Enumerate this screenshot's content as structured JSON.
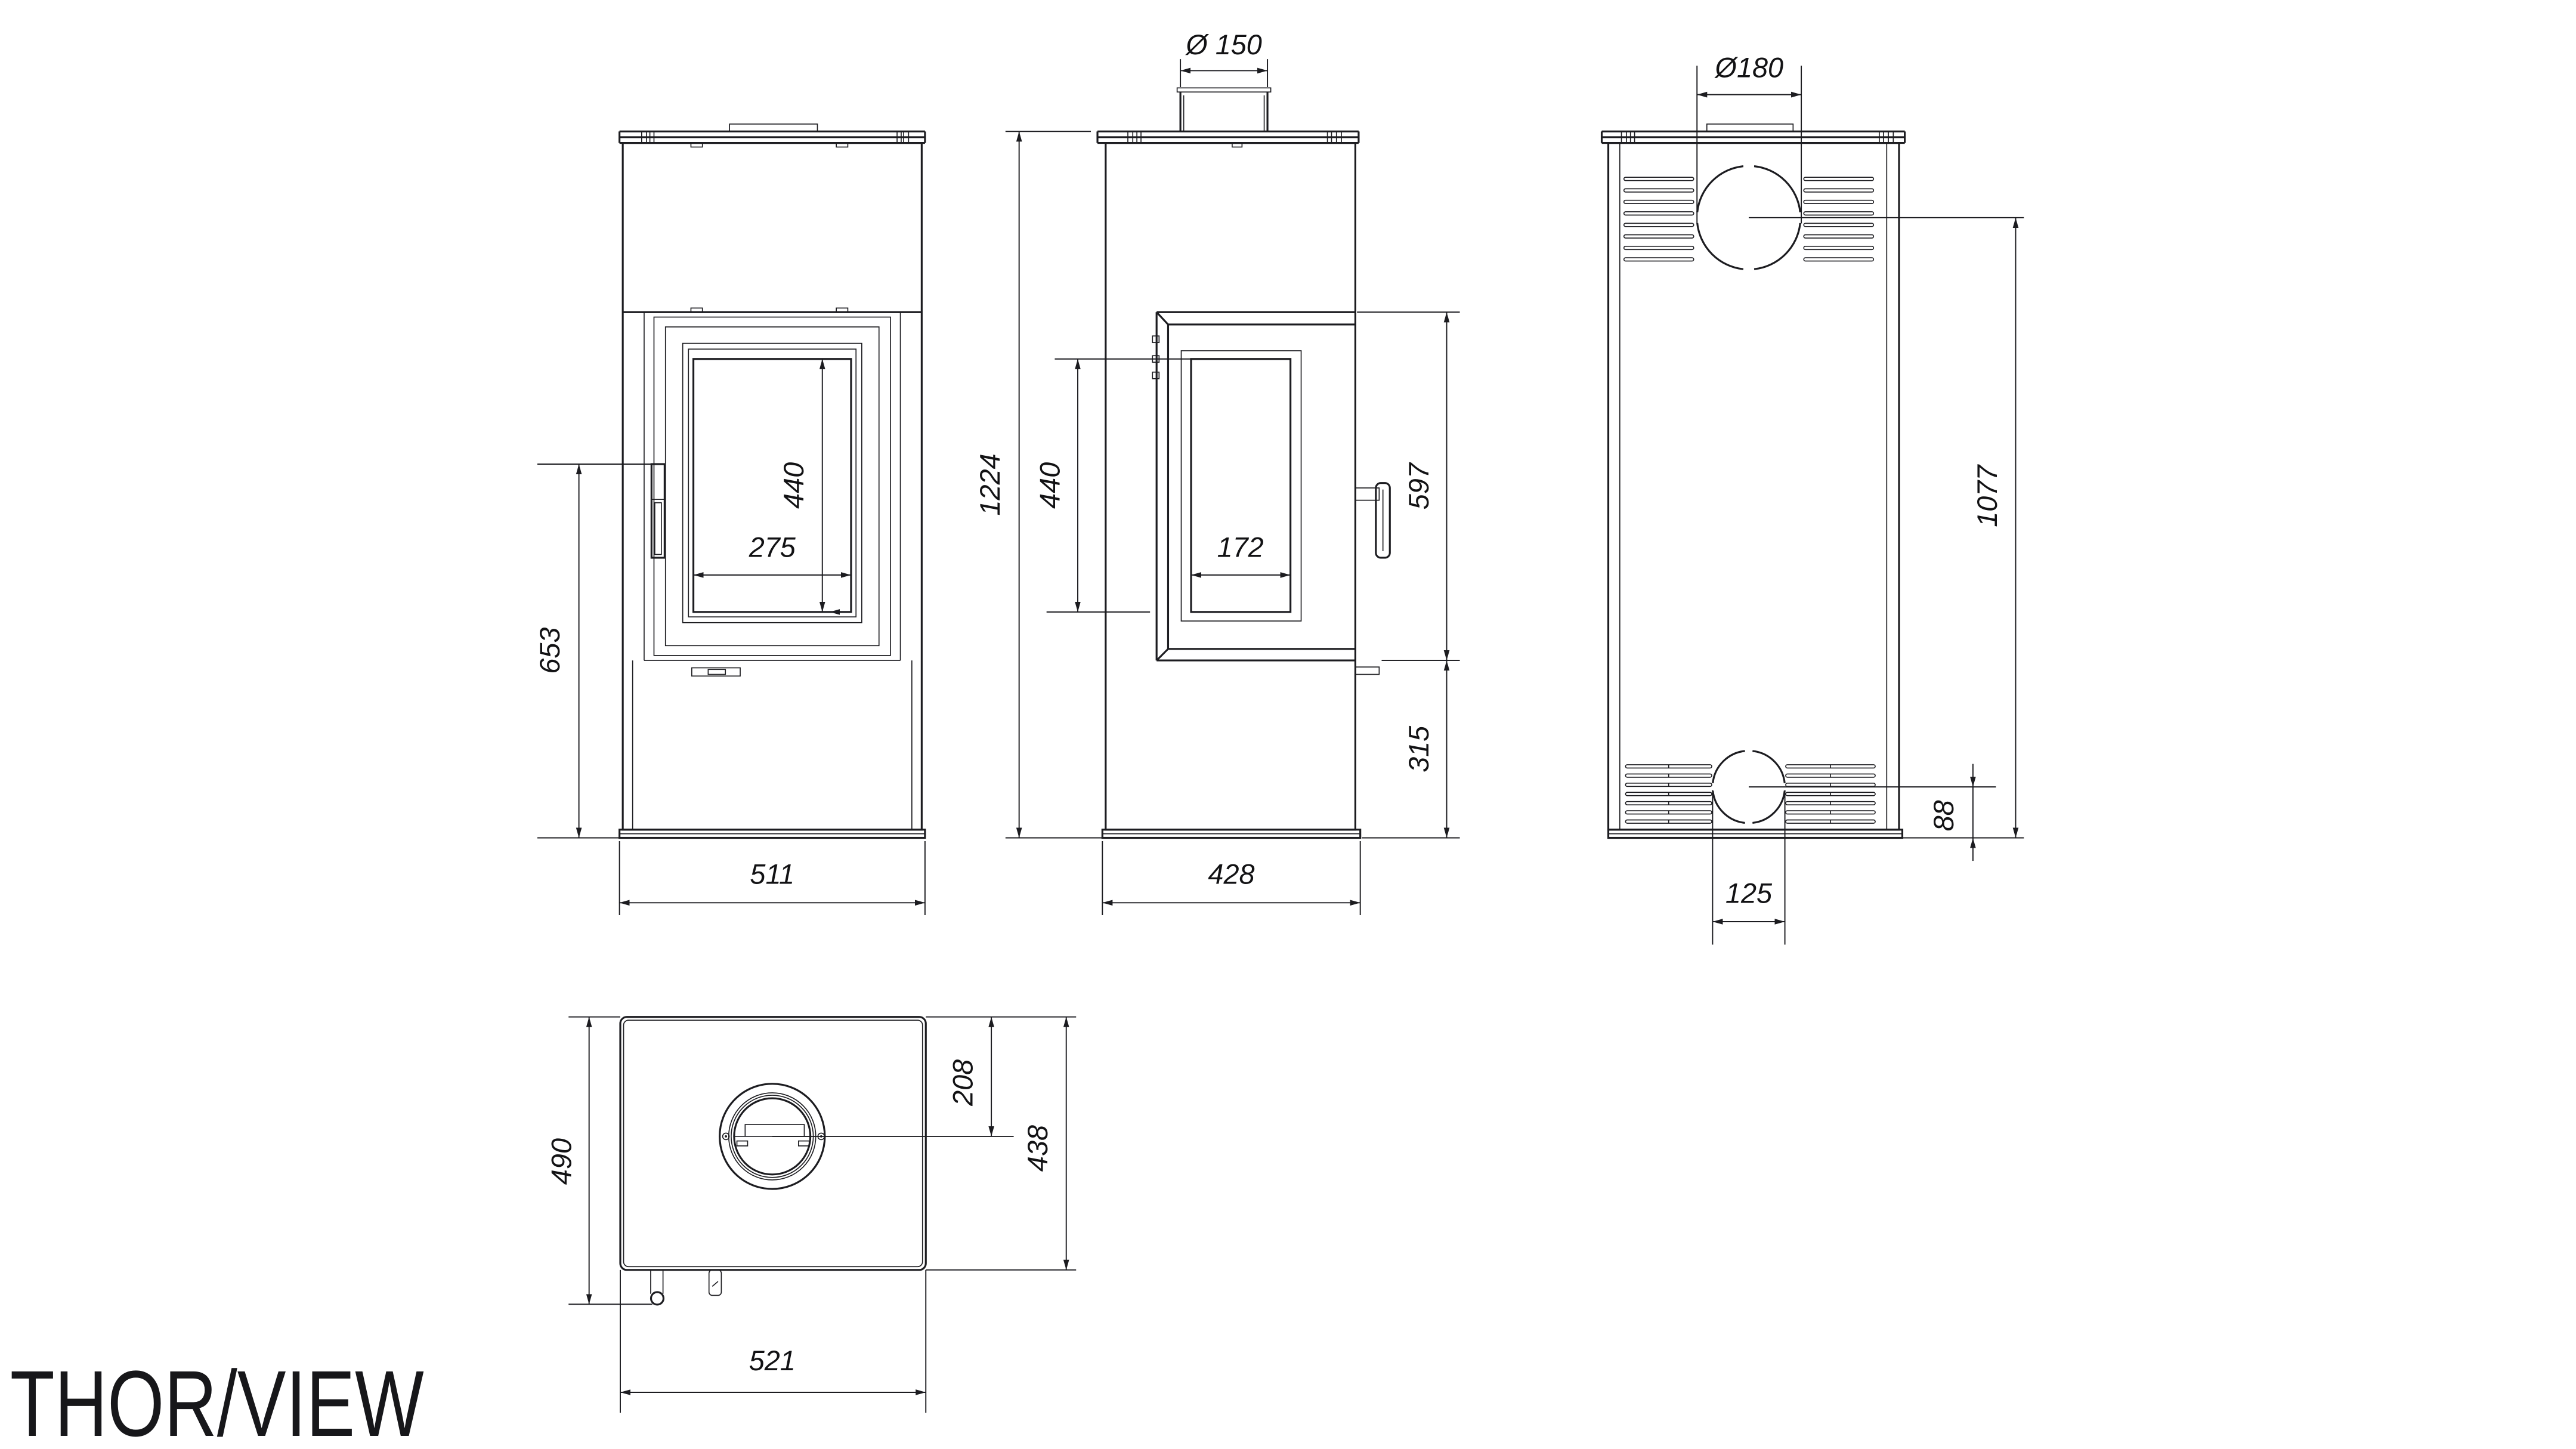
{
  "title": "THOR/VIEW",
  "drawing": {
    "background": "#ffffff",
    "line_color": "#1c1c20",
    "views": {
      "front": {
        "dims": [
          {
            "label": "653"
          },
          {
            "label": "275"
          },
          {
            "label": "440"
          },
          {
            "label": "511"
          }
        ]
      },
      "side": {
        "dims": [
          {
            "label": "Ø 150"
          },
          {
            "label": "1224"
          },
          {
            "label": "440"
          },
          {
            "label": "172"
          },
          {
            "label": "597"
          },
          {
            "label": "315"
          },
          {
            "label": "428"
          }
        ]
      },
      "back": {
        "dims": [
          {
            "label": "Ø180"
          },
          {
            "label": "1077"
          },
          {
            "label": "88"
          },
          {
            "label": "125"
          }
        ]
      },
      "top": {
        "dims": [
          {
            "label": "490"
          },
          {
            "label": "208"
          },
          {
            "label": "438"
          },
          {
            "label": "521"
          }
        ]
      }
    }
  }
}
